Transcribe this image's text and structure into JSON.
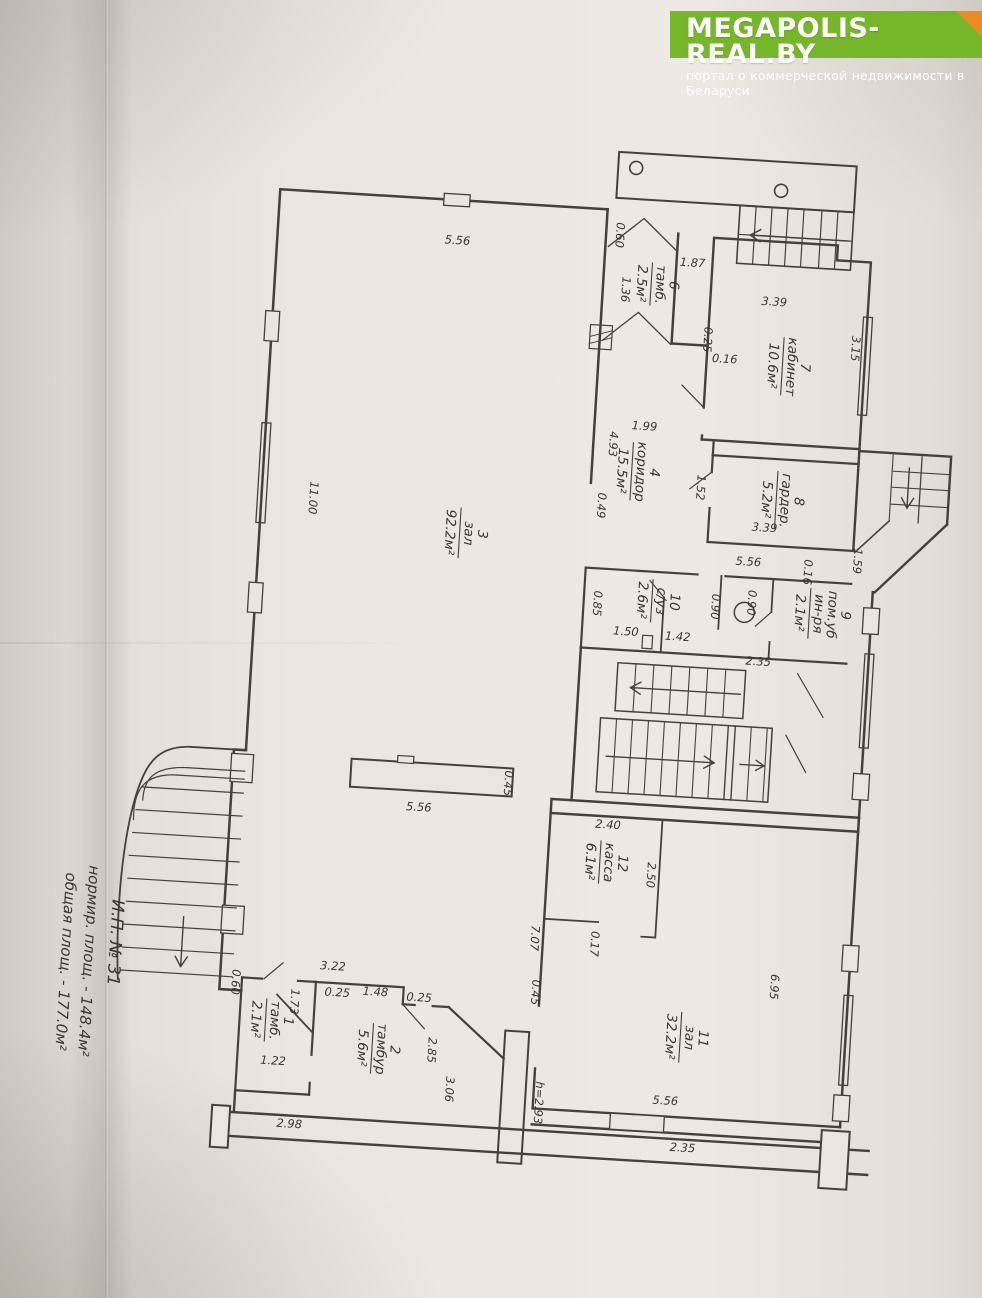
{
  "banner": {
    "title": "MEGAPOLIS-REAL.BY",
    "subtitle": "портал о коммерческой недвижимости в Беларуси",
    "bg_color": "#76b629",
    "fold_color": "#ee8a22"
  },
  "annotation": {
    "line1": "И.П. № 31",
    "line2": "нормир. площ. - 148.4м²",
    "line3": "общая площ. - 177.0м²"
  },
  "plan": {
    "stroke_color": "#45413a",
    "paper_color": "#e9e6df",
    "rooms": [
      {
        "lines": [
          "1",
          "тамб."
        ],
        "area": "2.1м²",
        "x": 288,
        "y": 1036
      },
      {
        "lines": [
          "2",
          "тамбур"
        ],
        "area": "5.6м²",
        "x": 396,
        "y": 1058
      },
      {
        "lines": [
          "3",
          "зал"
        ],
        "area": "92.2м²",
        "x": 452,
        "y": 538
      },
      {
        "lines": [
          "4",
          "коридор"
        ],
        "area": "15.5м²",
        "x": 620,
        "y": 466
      },
      {
        "lines": [
          "6",
          "тамб."
        ],
        "area": "2.5м²",
        "x": 628,
        "y": 278
      },
      {
        "lines": [
          "7",
          "кабинет"
        ],
        "area": "10.6м²",
        "x": 764,
        "y": 352
      },
      {
        "lines": [
          "8",
          "гардер."
        ],
        "area": "5.2м²",
        "x": 766,
        "y": 486
      },
      {
        "lines": [
          "9",
          "пом.уб",
          "ин-ря"
        ],
        "area": "2.1м²",
        "x": 806,
        "y": 597
      },
      {
        "lines": [
          "10",
          "с/уз"
        ],
        "area": "2.6м²",
        "x": 648,
        "y": 594
      },
      {
        "lines": [
          "11",
          "зал"
        ],
        "area": "32.2м²",
        "x": 703,
        "y": 1028
      },
      {
        "lines": [
          "12",
          "касса"
        ],
        "area": "6.1м²",
        "x": 612,
        "y": 858
      }
    ],
    "dimensions": [
      {
        "t": "5.56",
        "x": 432,
        "y": 250,
        "r": 0
      },
      {
        "t": "11.00",
        "x": 300,
        "y": 512,
        "r": 1
      },
      {
        "t": "0.60",
        "x": 590,
        "y": 231,
        "r": 1
      },
      {
        "t": "1.87",
        "x": 668,
        "y": 258,
        "r": 0
      },
      {
        "t": "1.36",
        "x": 599,
        "y": 285,
        "r": 1
      },
      {
        "t": "3.39",
        "x": 752,
        "y": 292,
        "r": 0
      },
      {
        "t": "3.15",
        "x": 832,
        "y": 330,
        "r": 1
      },
      {
        "t": "0.25",
        "x": 684,
        "y": 330,
        "r": 1
      },
      {
        "t": "0.16",
        "x": 706,
        "y": 352,
        "r": 0
      },
      {
        "t": "1.99",
        "x": 630,
        "y": 424,
        "r": 0
      },
      {
        "t": "4.93",
        "x": 596,
        "y": 440,
        "r": 1
      },
      {
        "t": "0.49",
        "x": 588,
        "y": 502,
        "r": 1
      },
      {
        "t": "1.52",
        "x": 686,
        "y": 478,
        "r": 1
      },
      {
        "t": "3.39",
        "x": 756,
        "y": 518,
        "r": 0
      },
      {
        "t": "1.59",
        "x": 847,
        "y": 542,
        "r": 1
      },
      {
        "t": "5.56",
        "x": 742,
        "y": 553,
        "r": 0
      },
      {
        "t": "0.85",
        "x": 590,
        "y": 600,
        "r": 1
      },
      {
        "t": "1.50",
        "x": 624,
        "y": 630,
        "r": 0
      },
      {
        "t": "1.42",
        "x": 676,
        "y": 632,
        "r": 0
      },
      {
        "t": "0.90",
        "x": 708,
        "y": 596,
        "r": 1
      },
      {
        "t": "0.90",
        "x": 744,
        "y": 590,
        "r": 1
      },
      {
        "t": "2.35",
        "x": 758,
        "y": 652,
        "r": 0
      },
      {
        "t": "0.16",
        "x": 798,
        "y": 556,
        "r": 1
      },
      {
        "t": "2.40",
        "x": 618,
        "y": 824,
        "r": 0
      },
      {
        "t": "2.50",
        "x": 660,
        "y": 868,
        "r": 1
      },
      {
        "t": "0.17",
        "x": 608,
        "y": 940,
        "r": 1
      },
      {
        "t": "7.07",
        "x": 548,
        "y": 938,
        "r": 1
      },
      {
        "t": "0.45",
        "x": 552,
        "y": 992,
        "r": 1
      },
      {
        "t": "6.95",
        "x": 790,
        "y": 972,
        "r": 1
      },
      {
        "t": "5.56",
        "x": 692,
        "y": 1096,
        "r": 0
      },
      {
        "t": "5.56",
        "x": 428,
        "y": 818,
        "r": 0
      },
      {
        "t": "0.45",
        "x": 512,
        "y": 785,
        "r": 1
      },
      {
        "t": "3.22",
        "x": 352,
        "y": 982,
        "r": 0
      },
      {
        "t": "0.25",
        "x": 358,
        "y": 1008,
        "r": 0
      },
      {
        "t": "1.48",
        "x": 396,
        "y": 1005,
        "r": 0
      },
      {
        "t": "0.25",
        "x": 440,
        "y": 1008,
        "r": 0
      },
      {
        "t": "1.73",
        "x": 312,
        "y": 1016,
        "r": 1
      },
      {
        "t": "0.60",
        "x": 252,
        "y": 1000,
        "r": 1
      },
      {
        "t": "1.22",
        "x": 298,
        "y": 1080,
        "r": 0
      },
      {
        "t": "2.85",
        "x": 452,
        "y": 1056,
        "r": 1
      },
      {
        "t": "3.06",
        "x": 472,
        "y": 1094,
        "r": 1
      },
      {
        "t": "2.98",
        "x": 318,
        "y": 1142,
        "r": 0
      },
      {
        "t": "2.35",
        "x": 712,
        "y": 1142,
        "r": 0
      },
      {
        "t": "h=2.93",
        "x": 562,
        "y": 1102,
        "r": 1
      }
    ]
  }
}
